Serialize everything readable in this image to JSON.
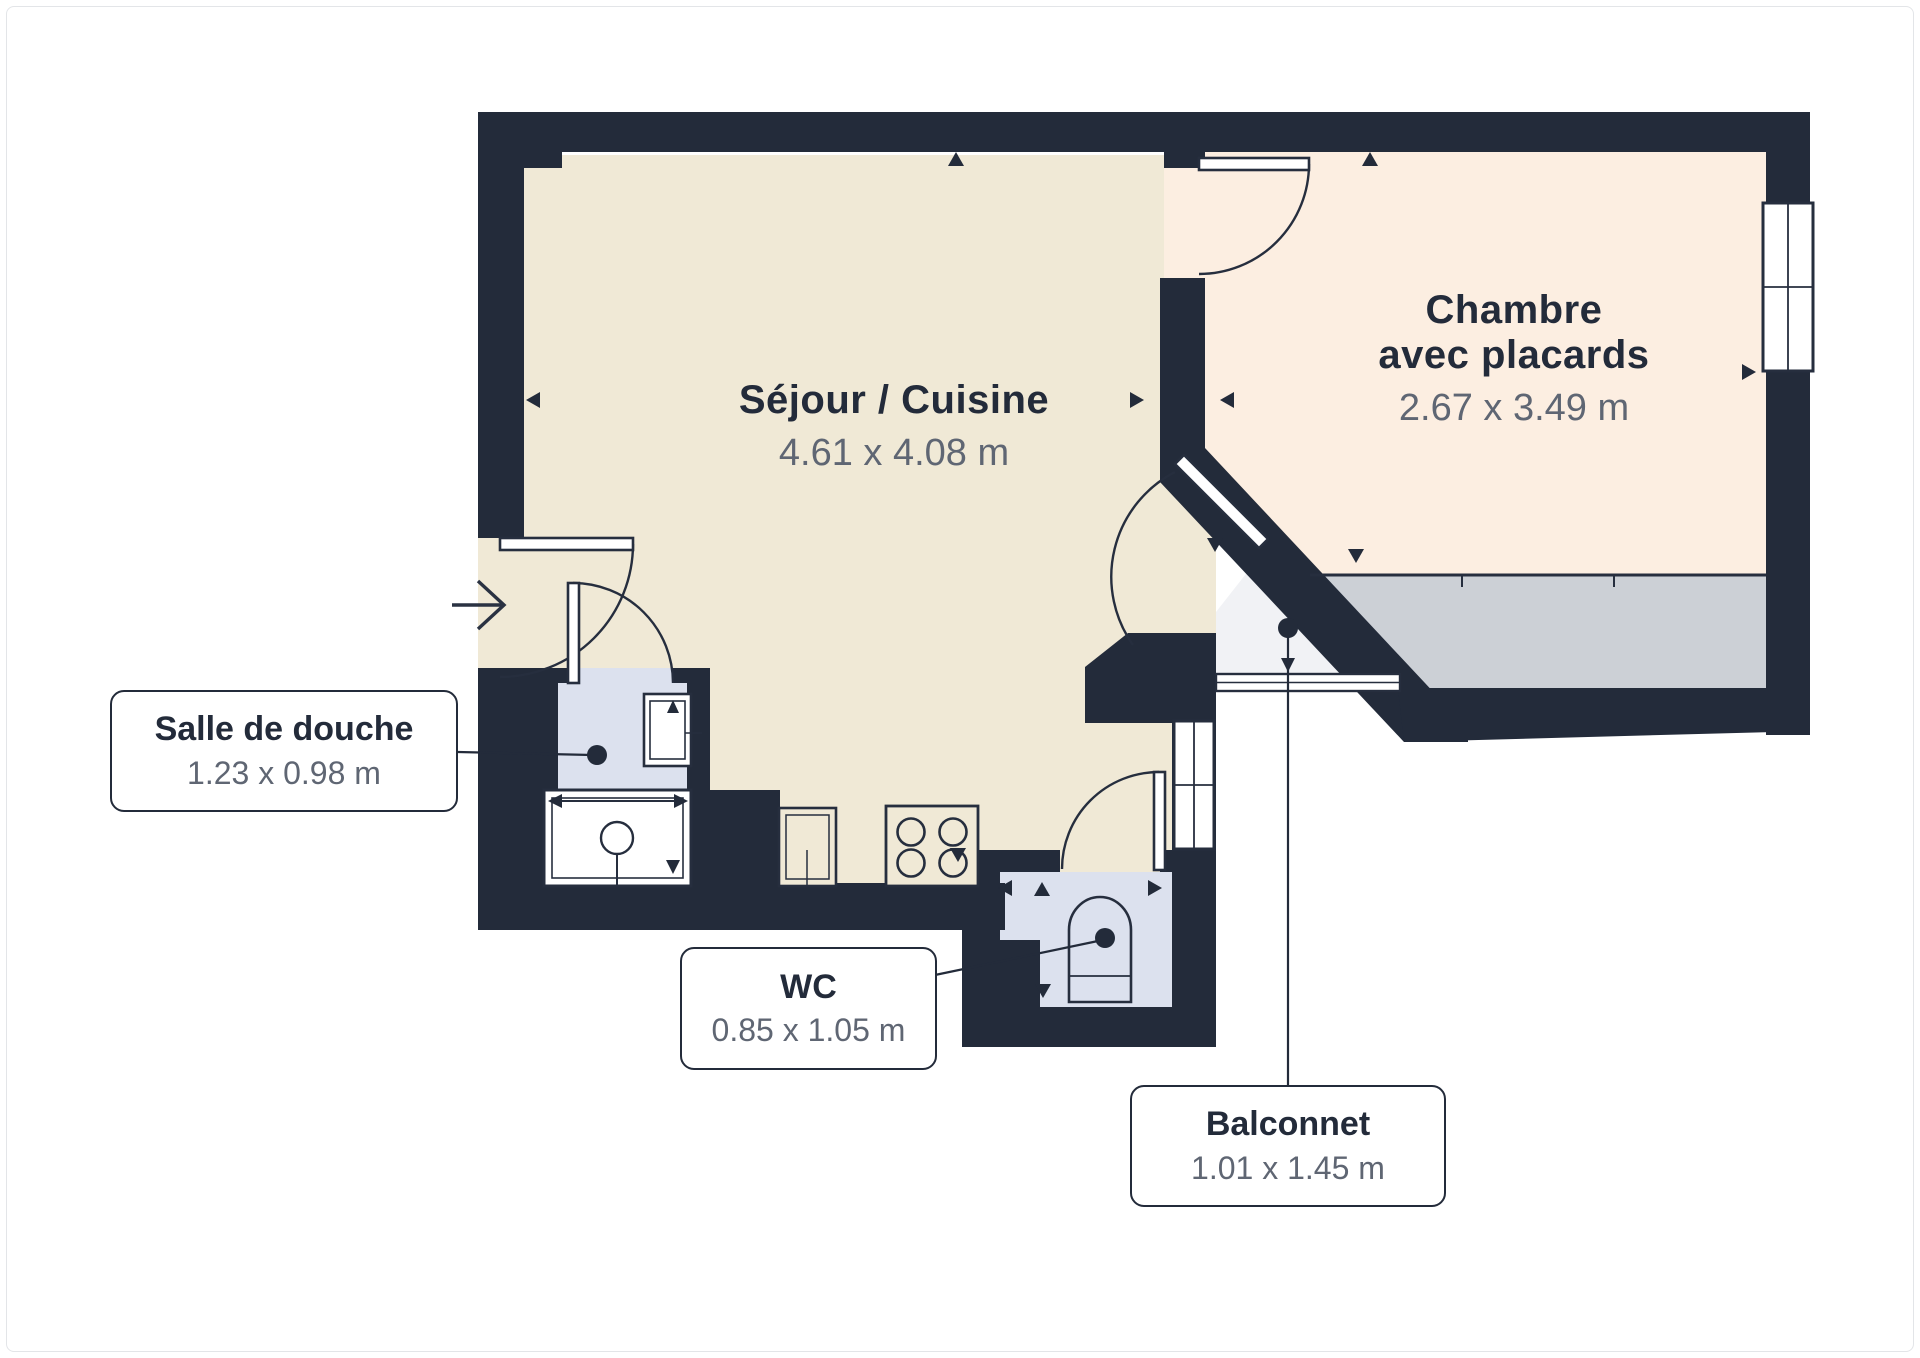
{
  "plan": {
    "rooms": {
      "sejour": {
        "name": "Séjour / Cuisine",
        "dims": "4.61 x 4.08 m"
      },
      "chambre": {
        "name_line1": "Chambre",
        "name_line2": "avec placards",
        "dims": "2.67 x 3.49 m"
      }
    },
    "callouts": {
      "salle_de_douche": {
        "name": "Salle de douche",
        "dims": "1.23 x 0.98 m"
      },
      "wc": {
        "name": "WC",
        "dims": "0.85 x 1.05 m"
      },
      "balconnet": {
        "name": "Balconnet",
        "dims": "1.01 x 1.45 m"
      }
    },
    "colors": {
      "wall": "#232b3a",
      "sejour_floor": "#f0e9d6",
      "chambre_floor": "#fceee1",
      "wet_room_floor": "#dce1ee",
      "balcony_floor": "#f1f2f5",
      "closet_strip": "#ccd0d6",
      "dim_text": "#5f6673",
      "name_text": "#232b3a"
    },
    "icons": [
      "entry-arrow-icon",
      "door-swing-icon",
      "window-icon",
      "stove-icon",
      "shower-icon",
      "sink-icon",
      "toilet-icon"
    ]
  }
}
